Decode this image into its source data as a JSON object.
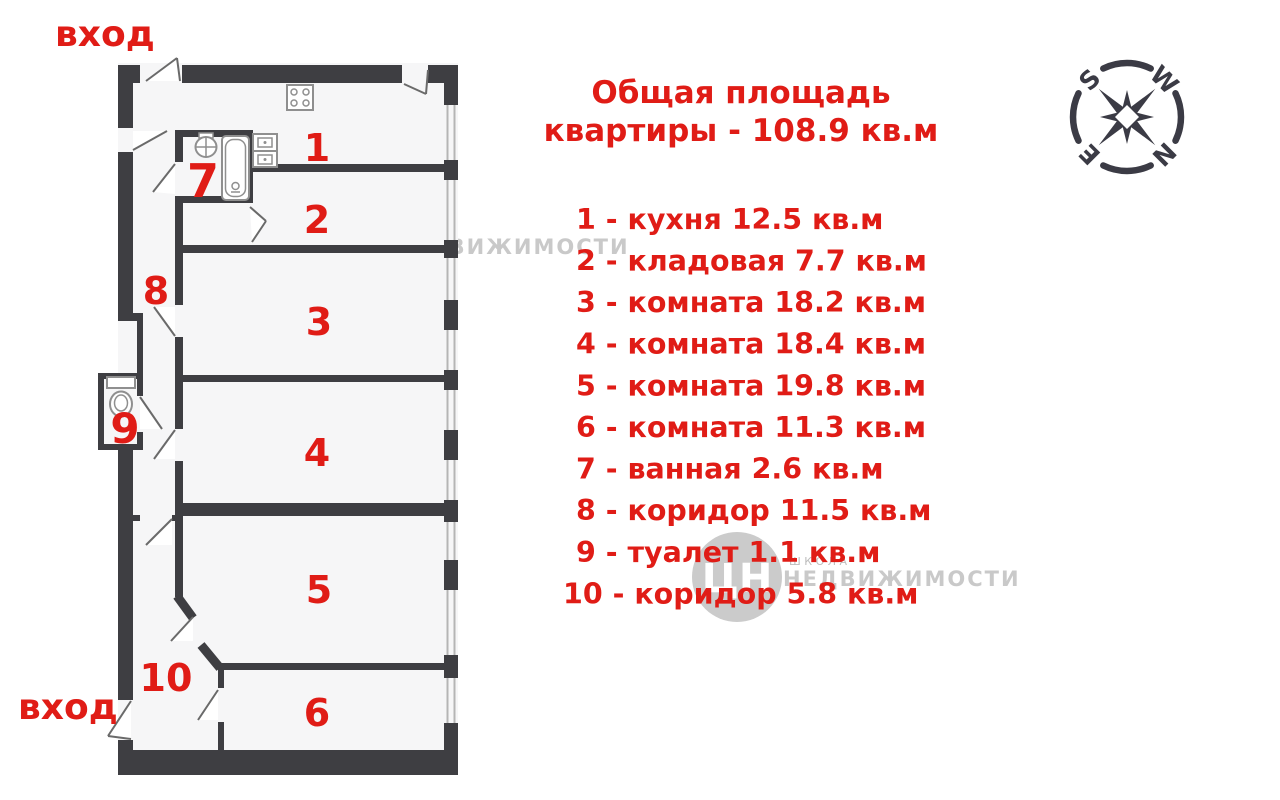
{
  "title": {
    "line1": "Общая площадь",
    "line2": "квартиры - 108.9 кв.м"
  },
  "entrance": {
    "top": "вход",
    "bottom": "вход"
  },
  "rooms": [
    {
      "num": "1",
      "legend": "1 - кухня 12.5 кв.м"
    },
    {
      "num": "2",
      "legend": "2 - кладовая 7.7 кв.м"
    },
    {
      "num": "3",
      "legend": "3 - комната 18.2 кв.м"
    },
    {
      "num": "4",
      "legend": "4 - комната 18.4 кв.м"
    },
    {
      "num": "5",
      "legend": "5 - комната 19.8 кв.м"
    },
    {
      "num": "6",
      "legend": "6 - комната 11.3 кв.м"
    },
    {
      "num": "7",
      "legend": "7 - ванная 2.6 кв.м"
    },
    {
      "num": "8",
      "legend": "8 - коридор 11.5 кв.м"
    },
    {
      "num": "9",
      "legend": "9 - туалет 1.1 кв.м"
    },
    {
      "num": "10",
      "legend": "10 - коридор 5.8 кв.м"
    }
  ],
  "compass": {
    "s": "S",
    "w": "W",
    "e": "E",
    "n": "N"
  },
  "watermarks": {
    "logo_text": "ЦН",
    "school": "ШКОЛА",
    "brand": "НЕДВИЖИМОСТИ",
    "etagi": "etagi"
  },
  "colors": {
    "accent_red": "#e01c16",
    "wall_gray": "#3e3e42",
    "compass_gray": "#3b3b45",
    "watermark_gray": "#c9c9c9"
  }
}
